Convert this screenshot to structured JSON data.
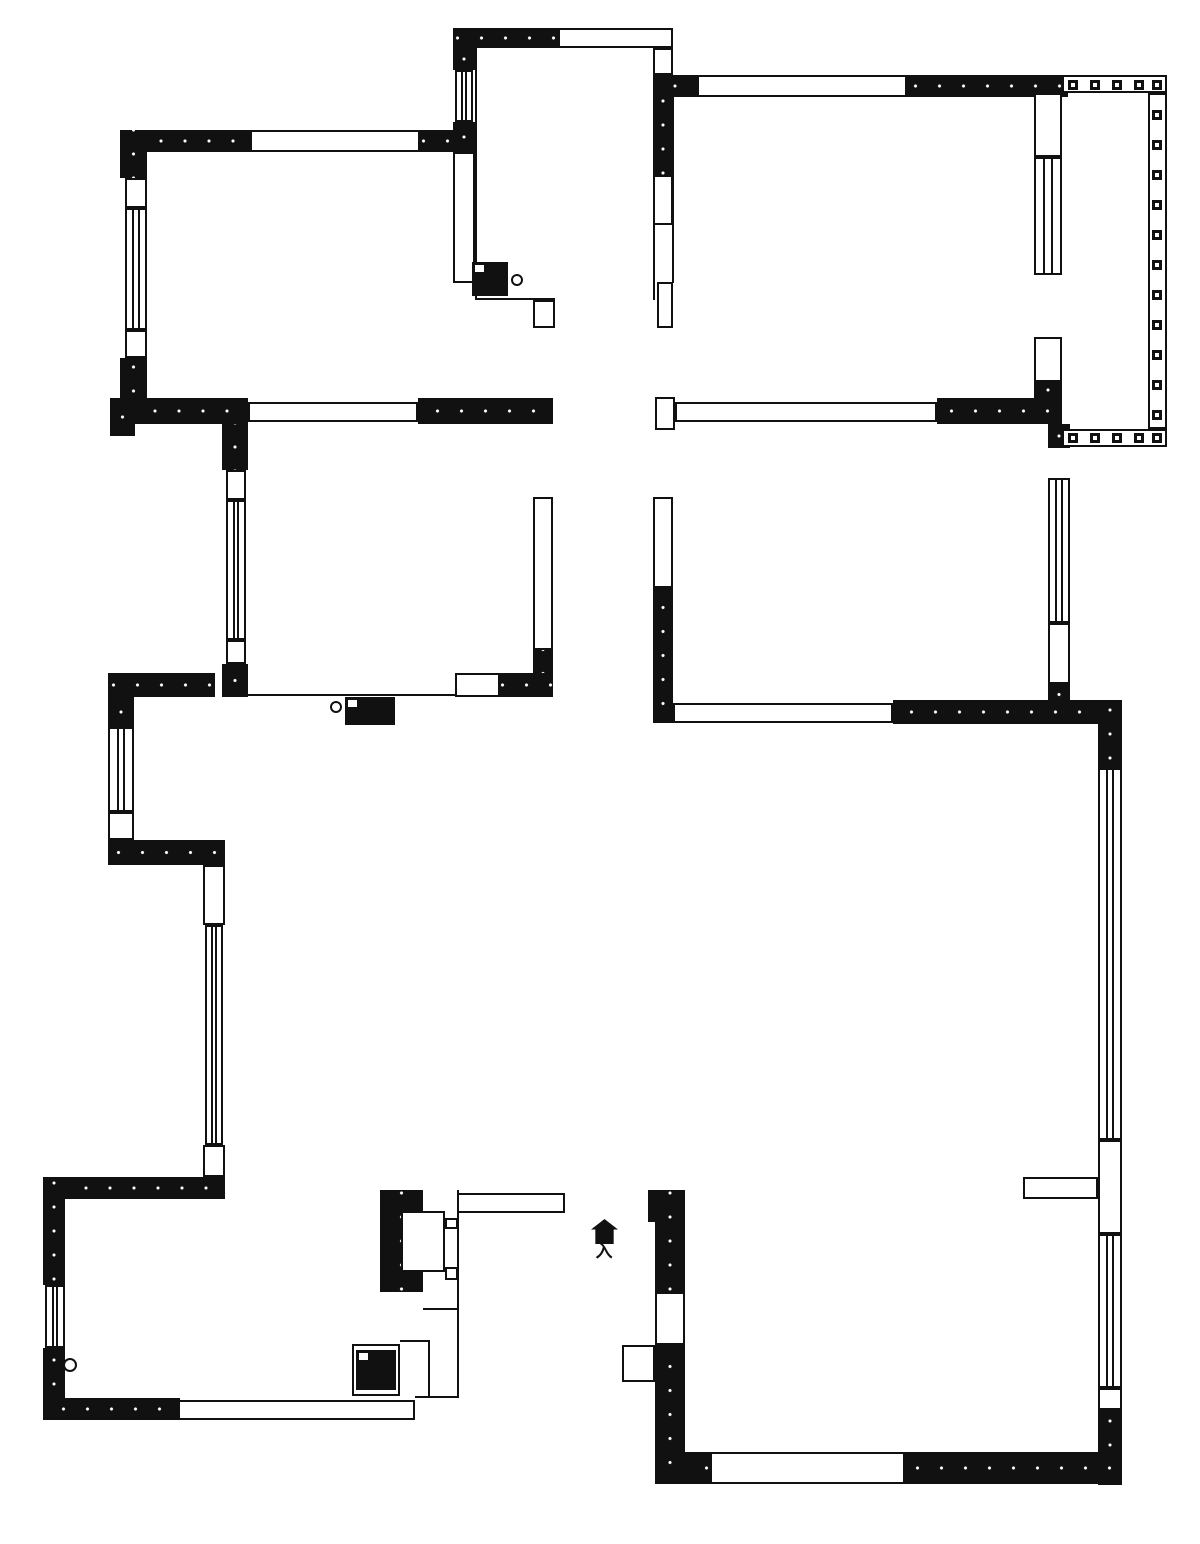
{
  "meta": {
    "type": "apartment-floor-plan",
    "canvas_width": 1200,
    "canvas_height": 1544,
    "wall_color": "#111111",
    "background_color": "#ffffff"
  },
  "labels": {
    "entry": "入",
    "meter_box": "燃气表"
  },
  "plan": {
    "walls_black": [
      [
        453,
        28,
        105,
        20
      ],
      [
        120,
        130,
        130,
        22
      ],
      [
        420,
        130,
        55,
        22
      ],
      [
        453,
        48,
        22,
        22
      ],
      [
        453,
        122,
        22,
        30
      ],
      [
        120,
        130,
        27,
        48
      ],
      [
        120,
        358,
        27,
        66
      ],
      [
        110,
        398,
        138,
        26
      ],
      [
        418,
        398,
        135,
        26
      ],
      [
        110,
        398,
        25,
        38
      ],
      [
        222,
        424,
        26,
        46
      ],
      [
        222,
        664,
        26,
        33
      ],
      [
        533,
        650,
        20,
        47
      ],
      [
        108,
        673,
        107,
        24
      ],
      [
        500,
        673,
        53,
        24
      ],
      [
        653,
        75,
        20,
        100
      ],
      [
        653,
        75,
        44,
        22
      ],
      [
        907,
        75,
        161,
        22
      ],
      [
        1034,
        382,
        28,
        16
      ],
      [
        937,
        398,
        125,
        26
      ],
      [
        1048,
        424,
        22,
        24
      ],
      [
        1048,
        684,
        22,
        21
      ],
      [
        653,
        588,
        20,
        135
      ],
      [
        893,
        700,
        229,
        24
      ],
      [
        1098,
        700,
        24,
        68
      ],
      [
        1098,
        1405,
        24,
        80
      ],
      [
        905,
        1452,
        217,
        32
      ],
      [
        655,
        1452,
        55,
        32
      ],
      [
        648,
        1190,
        37,
        32
      ],
      [
        655,
        1190,
        30,
        102
      ],
      [
        655,
        1345,
        30,
        139
      ],
      [
        380,
        1190,
        43,
        102
      ],
      [
        43,
        1177,
        182,
        22
      ],
      [
        43,
        1177,
        22,
        108
      ],
      [
        43,
        1348,
        22,
        72
      ],
      [
        43,
        1398,
        137,
        22
      ],
      [
        108,
        840,
        117,
        25
      ],
      [
        108,
        697,
        26,
        30
      ]
    ],
    "walls_white": [
      [
        558,
        28,
        115,
        20
      ],
      [
        653,
        48,
        20,
        27
      ],
      [
        250,
        130,
        170,
        22
      ],
      [
        125,
        178,
        22,
        30
      ],
      [
        125,
        330,
        22,
        28
      ],
      [
        248,
        402,
        170,
        20
      ],
      [
        226,
        470,
        20,
        30
      ],
      [
        226,
        640,
        20,
        24
      ],
      [
        453,
        152,
        22,
        131
      ],
      [
        653,
        175,
        20,
        50
      ],
      [
        657,
        282,
        16,
        46
      ],
      [
        533,
        300,
        22,
        28
      ],
      [
        533,
        497,
        20,
        153
      ],
      [
        653,
        497,
        20,
        91
      ],
      [
        655,
        397,
        20,
        33
      ],
      [
        675,
        402,
        262,
        20
      ],
      [
        1034,
        93,
        28,
        64
      ],
      [
        1034,
        337,
        28,
        45
      ],
      [
        697,
        75,
        210,
        22
      ],
      [
        1048,
        623,
        22,
        61
      ],
      [
        673,
        703,
        220,
        20
      ],
      [
        1098,
        1140,
        24,
        94
      ],
      [
        1023,
        1177,
        75,
        22
      ],
      [
        1098,
        1388,
        24,
        22
      ],
      [
        710,
        1452,
        195,
        32
      ],
      [
        655,
        1292,
        30,
        53
      ],
      [
        622,
        1345,
        33,
        37
      ],
      [
        203,
        865,
        22,
        60
      ],
      [
        203,
        1145,
        22,
        32
      ],
      [
        178,
        1400,
        237,
        20
      ],
      [
        401,
        1211,
        44,
        61
      ],
      [
        445,
        1218,
        13,
        11
      ],
      [
        445,
        1267,
        13,
        13
      ],
      [
        457,
        1193,
        108,
        20
      ],
      [
        352,
        1344,
        48,
        52
      ],
      [
        455,
        673,
        45,
        24
      ],
      [
        108,
        812,
        26,
        28
      ]
    ],
    "windows": [
      [
        455,
        70,
        18,
        52,
        "v"
      ],
      [
        125,
        208,
        22,
        122,
        "v"
      ],
      [
        226,
        500,
        20,
        140,
        "v"
      ],
      [
        1034,
        157,
        28,
        118,
        "v"
      ],
      [
        1048,
        478,
        22,
        145,
        "v"
      ],
      [
        1098,
        768,
        24,
        372,
        "v"
      ],
      [
        1098,
        1234,
        24,
        154,
        "v"
      ],
      [
        108,
        727,
        26,
        85,
        "v"
      ],
      [
        205,
        925,
        18,
        220,
        "v"
      ],
      [
        45,
        1285,
        20,
        63,
        "v"
      ]
    ],
    "lines": [
      [
        475,
        48,
        475,
        300
      ],
      [
        653,
        48,
        653,
        300
      ],
      [
        475,
        298,
        555,
        298
      ],
      [
        672,
        97,
        672,
        283
      ],
      [
        248,
        694,
        455,
        694
      ],
      [
        457,
        1190,
        457,
        1398
      ],
      [
        423,
        1308,
        457,
        1308
      ],
      [
        400,
        1340,
        428,
        1340
      ],
      [
        428,
        1340,
        428,
        1398
      ],
      [
        415,
        1396,
        457,
        1396
      ]
    ],
    "balcony": {
      "bands": [
        [
          1062,
          75,
          105,
          18
        ],
        [
          1148,
          93,
          19,
          336
        ],
        [
          1062,
          429,
          105,
          18
        ]
      ],
      "squares_top_y": 80,
      "squares_top_x": [
        1068,
        1090,
        1112,
        1134,
        1152
      ],
      "squares_right_x": 1152,
      "squares_right_y": [
        110,
        140,
        170,
        200,
        230,
        260,
        290,
        320,
        350,
        380,
        410
      ],
      "squares_bottom_y": 433,
      "squares_bottom_x": [
        1068,
        1090,
        1112,
        1134,
        1152
      ]
    },
    "fixtures": {
      "boxes": [
        [
          472,
          262,
          36,
          34
        ],
        [
          345,
          697,
          50,
          28
        ],
        [
          356,
          1350,
          40,
          40
        ]
      ],
      "circles": [
        [
          517,
          280,
          6
        ],
        [
          336,
          707,
          6
        ],
        [
          70,
          1365,
          7
        ]
      ]
    }
  }
}
